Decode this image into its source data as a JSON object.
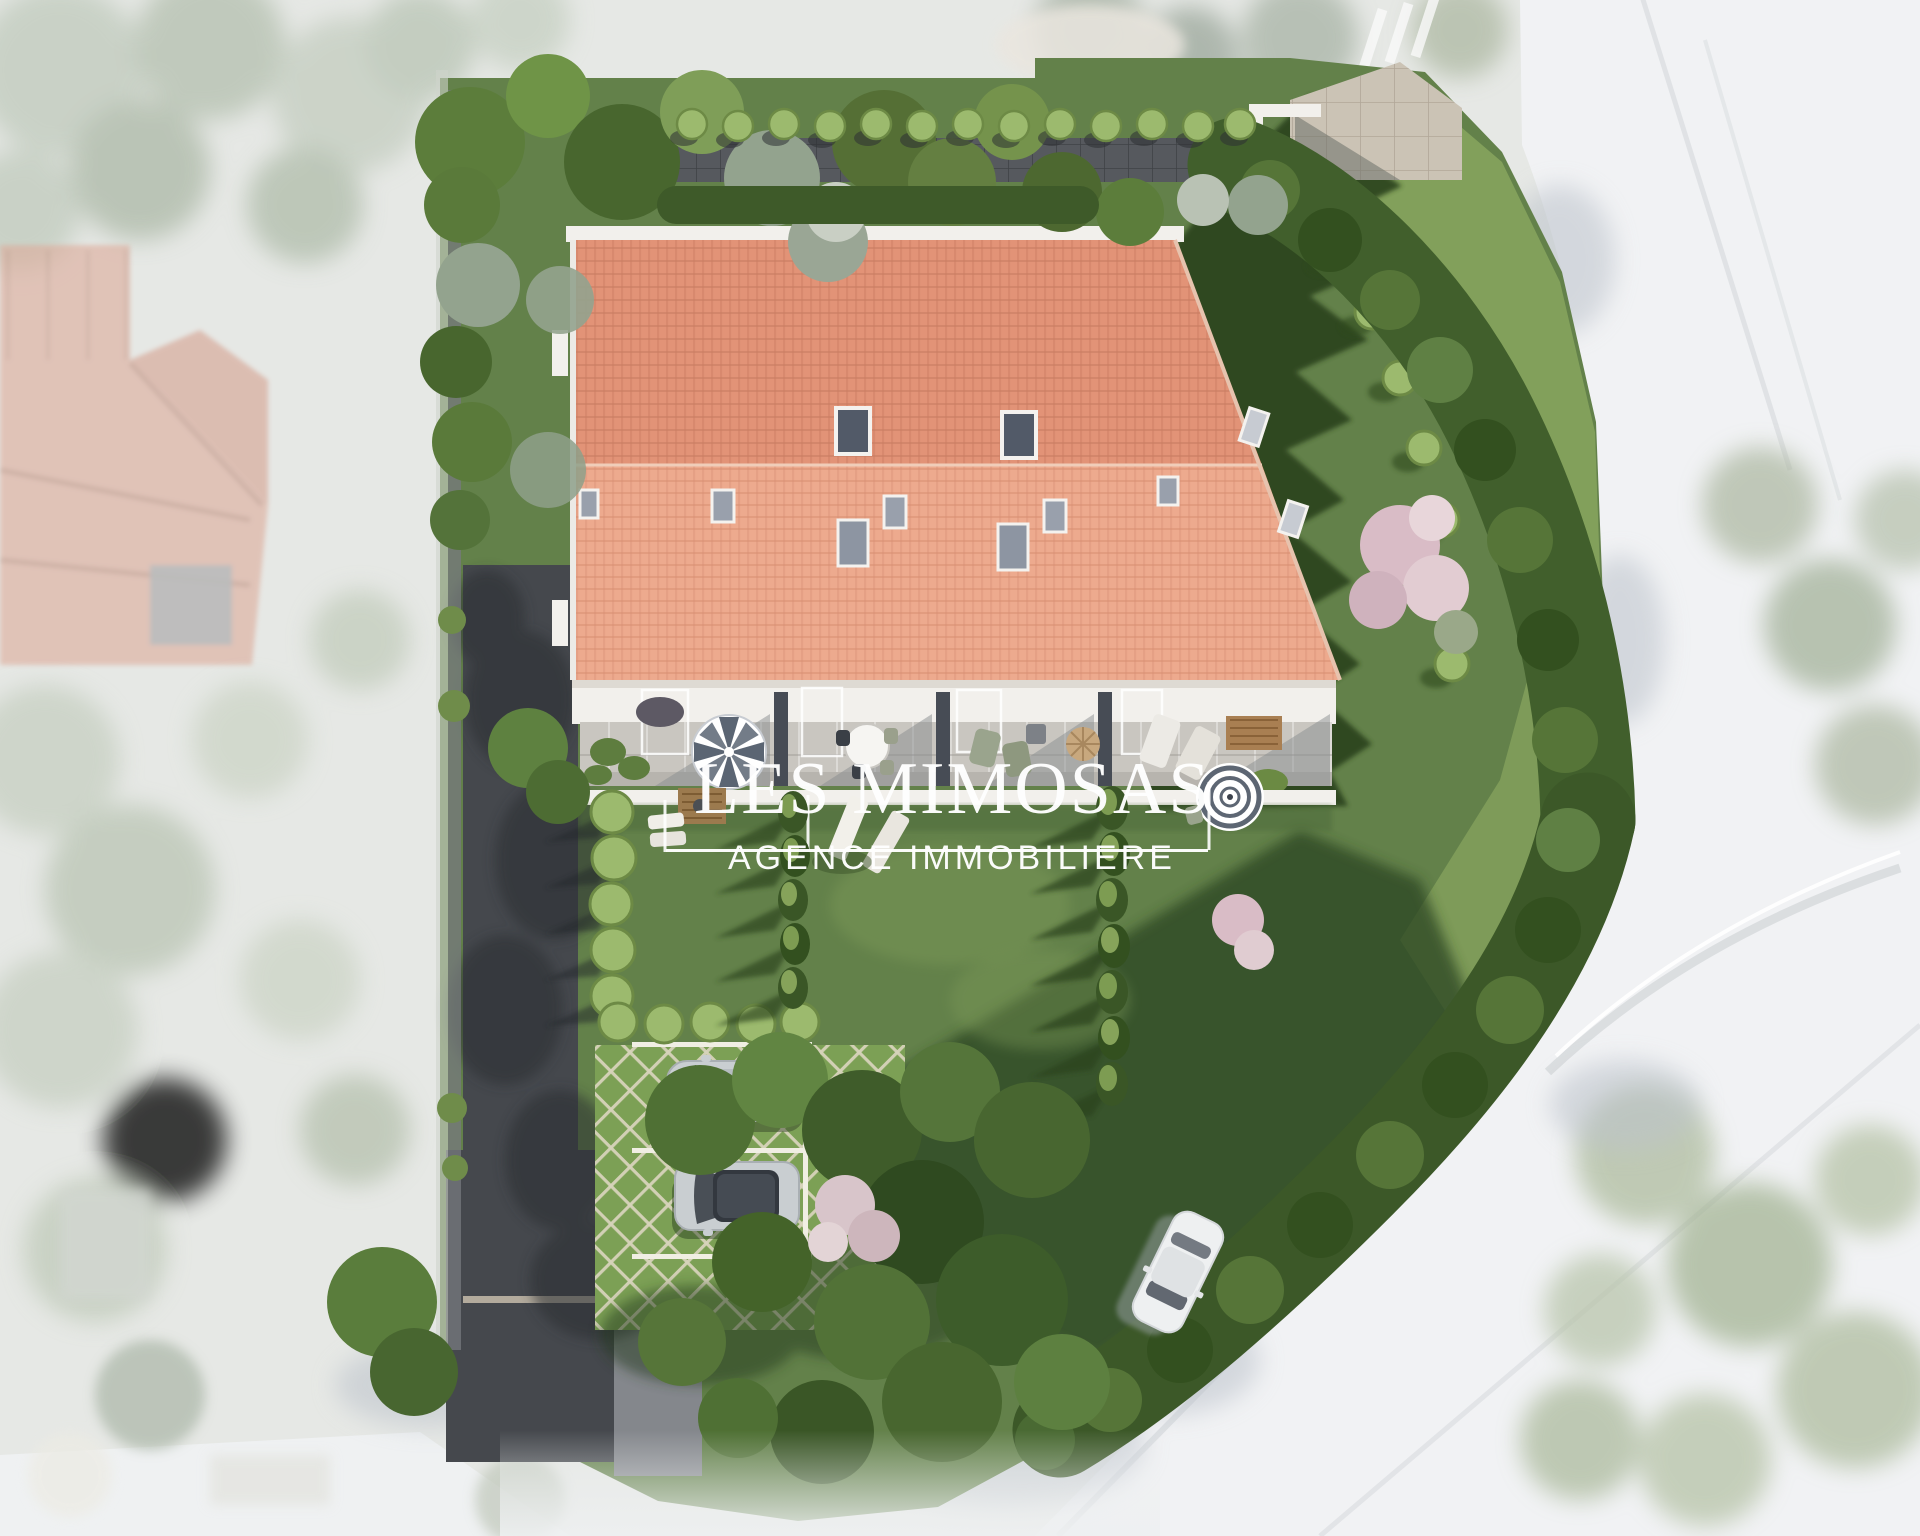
{
  "watermark": {
    "title": "LES MIMOSAS",
    "subtitle": "AGENCE IMMOBILIERE"
  },
  "palette": {
    "roof-upper": "#e29377",
    "roof-lower": "#edaa8e",
    "white-trim": "#f2f0ec",
    "grass": "#63814a",
    "grass-light": "#84a15c",
    "grass-dark": "#2a421f",
    "hedge-dark": "#415f2c",
    "hedge-mid": "#567538",
    "hedge-light": "#9cba6e",
    "tree-gray": "#93a38e",
    "blossom-pink": "#d9bcc6",
    "path-dark": "#56595e",
    "tile-beige": "#cbc3b5",
    "asphalt": "#45484d",
    "paver-grass": "#7ca055",
    "paver-line": "#d7d3ba",
    "road-white": "#f1f2f4",
    "faded-green": "#b9c4b2",
    "faded-roof": "#ddab9a",
    "car-silver": "#c9ced1",
    "car-glass": "#434a52",
    "watermark": "#ffffff"
  }
}
